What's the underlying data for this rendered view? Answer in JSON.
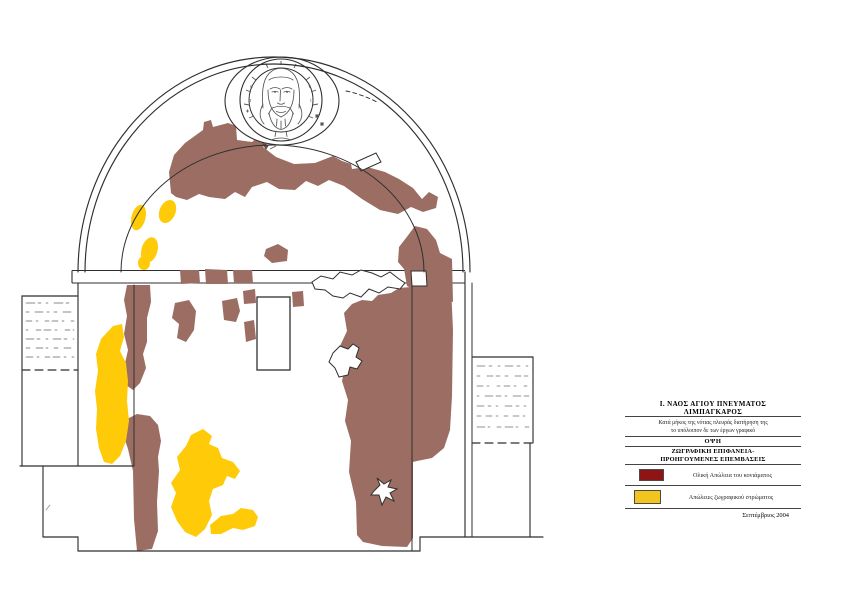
{
  "page": {
    "kind": "scanned conservation drawing",
    "background": "#ffffff"
  },
  "drawing": {
    "name": "church-cross-section-condition-drawing",
    "subject": "Vaulted church interior elevation with Christ medallion fresco",
    "colors": {
      "plaster_loss_area": "#9c6d63",
      "paint_loss_area": "#ffca08",
      "line": "#2f2f2f",
      "sketch": "#555555"
    }
  },
  "title_block": {
    "title_line1": "Ι. ΝΑΟΣ ΑΓΙΟΥ ΠΝΕΥΜΑΤΟΣ",
    "title_line2": "ΛΙΜΠΑΓΚΑΡΟΣ",
    "description_line1": "Κατά μήκος της νότιας πλευράς διατήρηση της",
    "description_line2": "το υπόλοιπον δε των έργων γραφικό",
    "view_label": "ΟΨΗ",
    "subject_line1": "ΖΩΓΡΑΦΙΚΗ ΕΠΙΦΑΝΕΙΑ-",
    "subject_line2": "ΠΡΟΗΓΟΥΜΕΝΕΣ ΕΠΕΜΒΑΣΕΙΣ",
    "legend": [
      {
        "key": "total_plaster_loss",
        "label": "Ολική Απώλεια του κονιάματος",
        "color": "#8e1515"
      },
      {
        "key": "paint_layer_loss",
        "label": "Απώλειες ζωγραφικού στρώματος",
        "color": "#f2c41e"
      }
    ],
    "date": "Σεπτέμβριος 2004"
  }
}
